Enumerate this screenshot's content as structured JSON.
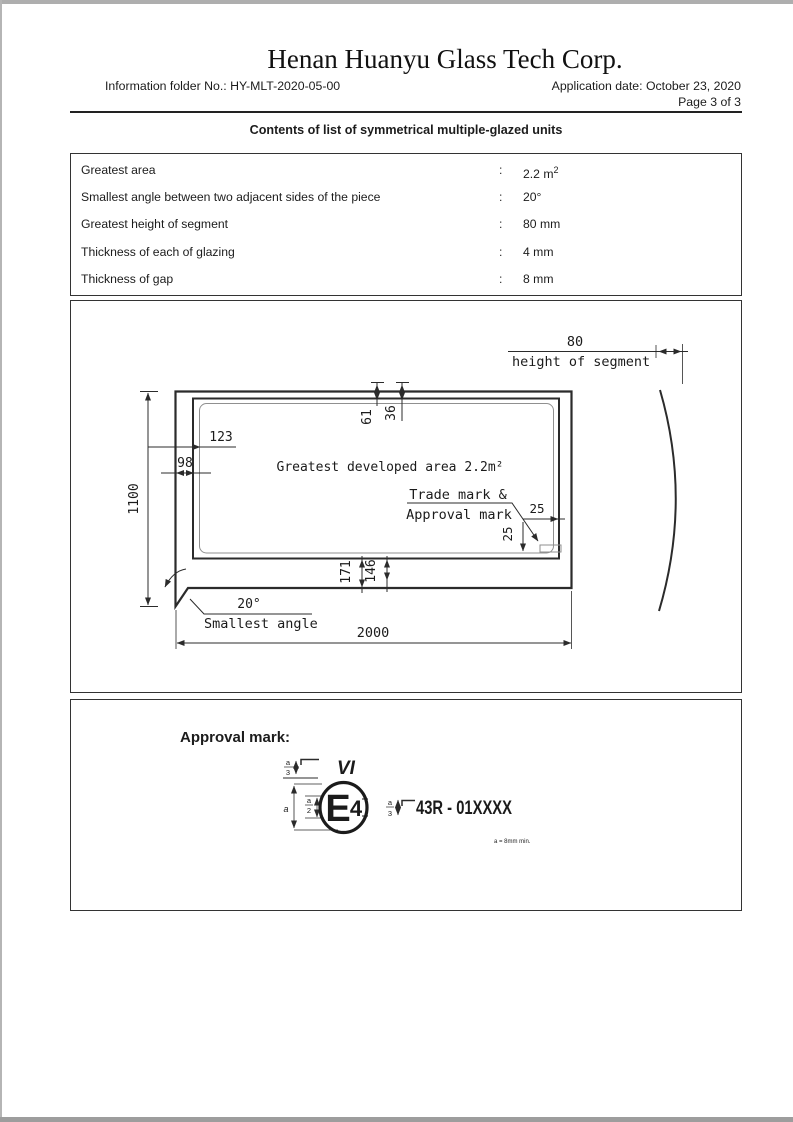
{
  "page": {
    "title": "Henan Huanyu Glass Tech Corp.",
    "info_folder": "Information folder No.: HY-MLT-2020-05-00",
    "application_date": "Application date: October 23, 2020",
    "page_number": "Page 3 of 3",
    "subtitle": "Contents of list of symmetrical multiple-glazed units"
  },
  "spec_table": {
    "rows": [
      {
        "label": "Greatest area",
        "sep": ":",
        "value": "2.2 m",
        "superscript": "2"
      },
      {
        "label": "Smallest angle between two adjacent sides of the piece",
        "sep": ":",
        "value": "20°"
      },
      {
        "label": "Greatest height of segment",
        "sep": ":",
        "value": "80 mm"
      },
      {
        "label": "Thickness of each of glazing",
        "sep": ":",
        "value": "4 mm"
      },
      {
        "label": "Thickness of gap",
        "sep": ":",
        "value": "8 mm"
      }
    ]
  },
  "drawing": {
    "dim_segment_height": "80",
    "segment_label": "height of segment",
    "dim_height": "1100",
    "dim_inset_123": "123",
    "dim_inset_98": "98",
    "dim_top_61": "61",
    "dim_top_36": "36",
    "area_label": "Greatest developed area 2.2m²",
    "trade_mark_line1": "Trade mark &",
    "trade_mark_line2": "Approval mark",
    "dim_mark_h": "25",
    "dim_mark_v": "25",
    "dim_bottom_171": "171",
    "dim_bottom_146": "146",
    "angle_value": "20°",
    "angle_label": "Smallest angle",
    "dim_width": "2000"
  },
  "approval": {
    "heading": "Approval mark:",
    "roman_numeral": "VI",
    "frac_num": "a",
    "frac_den3": "3",
    "frac_den2": "2",
    "dim_a": "a",
    "e_letter": "E",
    "e_number": "4",
    "regulation": "43R - 01XXXX",
    "footnote": "a = 8mm min."
  },
  "colors": {
    "line": "#2b2b2b",
    "thin_line": "#909090",
    "text": "#1b1b1b"
  }
}
